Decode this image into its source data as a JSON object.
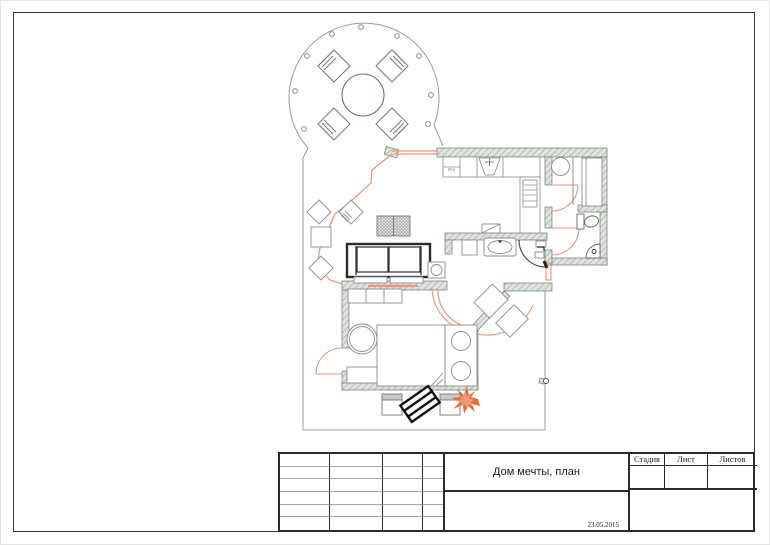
{
  "document": {
    "kind": "architectural floor plan sheet"
  },
  "plan": {
    "stove_label": "Очг"
  },
  "title_block": {
    "project_title": "Дом мечты, план",
    "date": "23.05.2015",
    "columns": {
      "stage": "Стадия",
      "sheet": "Лист",
      "sheets": "Листов"
    }
  },
  "colors": {
    "accent_salmon": "#F0927A",
    "wall_fill": "#DFE5DE",
    "wall_hatch": "#93A293",
    "line_gray": "#8C8C8C",
    "dark": "#2A2A2A",
    "table_green": "#55814F"
  }
}
